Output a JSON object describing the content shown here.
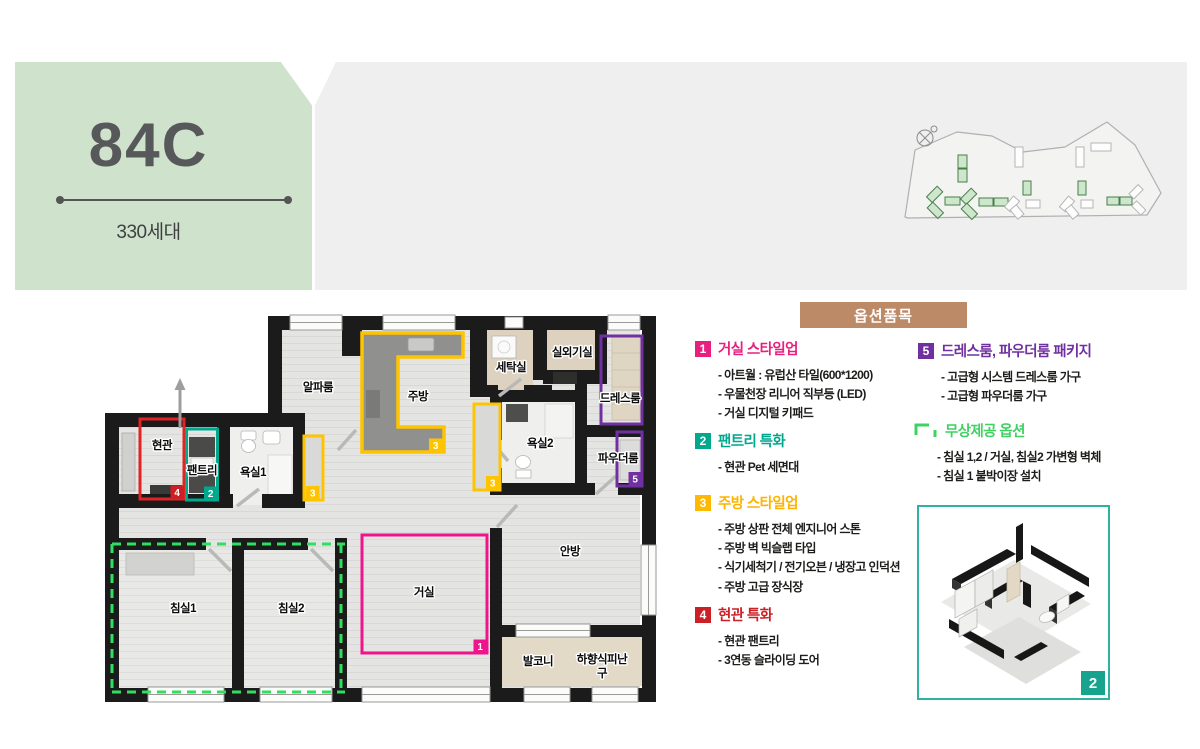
{
  "header": {
    "unit_type": "84C",
    "units_label": "330세대"
  },
  "options": {
    "header": "옵션품목",
    "sections": [
      {
        "num": "1",
        "key": "living",
        "title": "거실 스타일업",
        "items": [
          "아트월 : 유럽산 타일(600*1200)",
          "우물천장 리니어 직부등 (LED)",
          "거실 디지털 키패드"
        ]
      },
      {
        "num": "2",
        "key": "pantry",
        "title": "팬트리 특화",
        "items": [
          "현관 Pet 세면대"
        ]
      },
      {
        "num": "3",
        "key": "kitchen",
        "title": "주방 스타일업",
        "items": [
          "주방 상판 전체 엔지니어 스톤",
          "주방 벽 빅슬랩 타입",
          "식기세척기 / 전기오븐 / 냉장고 인덕션",
          "주방 고급 장식장"
        ]
      },
      {
        "num": "4",
        "key": "entrance",
        "title": "현관 특화",
        "items": [
          "현관 팬트리",
          "3연동 슬라이딩 도어"
        ]
      },
      {
        "num": "5",
        "key": "dressroom",
        "title": "드레스룸, 파우더룸 패키지",
        "items": [
          "고급형 시스템 드레스룸 가구",
          "고급형 파우더룸 가구"
        ]
      },
      {
        "num": "",
        "key": "free",
        "title": "무상제공 옵션",
        "items": [
          "침실 1,2 / 거실, 침실2 가변형 벽체",
          "침실 1 붙박이장 설치"
        ]
      }
    ]
  },
  "floor_plan": {
    "labels": {
      "entrance": "현관",
      "pantry": "팬트리",
      "bath1": "욕실1",
      "alpha": "알파룸",
      "kitchen": "주방",
      "laundry": "세탁실",
      "outdoor_unit": "실외기실",
      "dressroom": "드레스룸",
      "bath2": "욕실2",
      "powder": "파우더룸",
      "master": "안방",
      "living": "거실",
      "bed1": "침실1",
      "bed2": "침실2",
      "balcony": "발코니",
      "evac_line1": "하향식피난",
      "evac_line2": "구"
    },
    "badges": {
      "living": "1",
      "pantry": "2",
      "kitchen": "3",
      "entrance": "4",
      "dressroom": "5"
    }
  },
  "detail_image": {
    "badge": "2"
  },
  "colors": {
    "panel_green": "#cfe2cc",
    "panel_gray": "#efefef",
    "options_header_bg": "#bd8a68",
    "living_pink": "#e81f7f",
    "pantry_teal": "#00a88e",
    "kitchen_yellow": "#ffb900",
    "entrance_red": "#cc2027",
    "dressroom_purple": "#7030a0",
    "free_green": "#3fd162",
    "wall_black": "#1b1b1b",
    "flexible_wall_dash": "#2fe060"
  }
}
